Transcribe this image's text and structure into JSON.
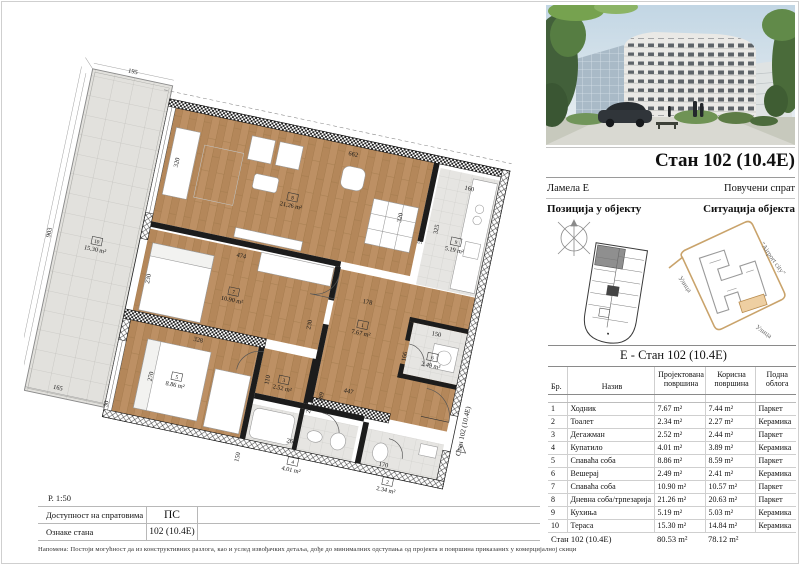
{
  "header": {
    "title": "Стан 102 (10.4Е)",
    "lamela": "Ламела Е",
    "floor": "Повучени спрат",
    "position_label": "Позиција у објекту",
    "situation_label": "Ситуација објекта"
  },
  "situation": {
    "label_top": "\"Airport city\"",
    "label_left": "Улица",
    "label_bottom": "Улица"
  },
  "area_table": {
    "title": "Е - Стан 102 (10.4Е)",
    "headers": {
      "no": "Бр.",
      "name": "Назив",
      "projected": "Пројектована површина",
      "useful": "Корисна површина",
      "flooring": "Подна облога"
    },
    "rows": [
      {
        "no": "1",
        "name": "Ходник",
        "projected": "7.67 m²",
        "useful": "7.44 m²",
        "flooring": "Паркет"
      },
      {
        "no": "2",
        "name": "Тоалет",
        "projected": "2.34 m²",
        "useful": "2.27 m²",
        "flooring": "Керамика"
      },
      {
        "no": "3",
        "name": "Дегажман",
        "projected": "2.52 m²",
        "useful": "2.44 m²",
        "flooring": "Паркет"
      },
      {
        "no": "4",
        "name": "Купатило",
        "projected": "4.01 m²",
        "useful": "3.89 m²",
        "flooring": "Керамика"
      },
      {
        "no": "5",
        "name": "Спаваћа соба",
        "projected": "8.86 m²",
        "useful": "8.59 m²",
        "flooring": "Паркет"
      },
      {
        "no": "6",
        "name": "Вешерај",
        "projected": "2.49 m²",
        "useful": "2.41 m²",
        "flooring": "Керамика"
      },
      {
        "no": "7",
        "name": "Спаваћа соба",
        "projected": "10.90 m²",
        "useful": "10.57 m²",
        "flooring": "Паркет"
      },
      {
        "no": "8",
        "name": "Дневна соба/трпезарија",
        "projected": "21.26 m²",
        "useful": "20.63 m²",
        "flooring": "Паркет"
      },
      {
        "no": "9",
        "name": "Кухиња",
        "projected": "5.19 m²",
        "useful": "5.03 m²",
        "flooring": "Керамика"
      },
      {
        "no": "10",
        "name": "Тераса",
        "projected": "15.30 m²",
        "useful": "14.84 m²",
        "flooring": "Керамика"
      }
    ],
    "total": {
      "label": "Стан 102 (10.4Е)",
      "projected": "80.53 m²",
      "useful": "78.12 m²",
      "flooring": ""
    }
  },
  "plan": {
    "scale": "Р. 1:50",
    "entrance_label": "Стан 102 (10.4Е)",
    "rooms": [
      {
        "num": "1",
        "area": "7.67 m²",
        "x": 352,
        "y": 228
      },
      {
        "num": "2",
        "area": "2.34 m²",
        "x": 412,
        "y": 384
      },
      {
        "num": "3",
        "area": "2.52 m²",
        "x": 283,
        "y": 302
      },
      {
        "num": "4",
        "area": "4.01 m²",
        "x": 310,
        "y": 384
      },
      {
        "num": "5",
        "area": "8.86 m²",
        "x": 172,
        "y": 322
      },
      {
        "num": "6",
        "area": "2.49 m²",
        "x": 431,
        "y": 246
      },
      {
        "num": "7",
        "area": "10.90 m²",
        "x": 212,
        "y": 222
      },
      {
        "num": "8",
        "area": "21.26 m²",
        "x": 252,
        "y": 112
      },
      {
        "num": "9",
        "area": "5.19 m²",
        "x": 430,
        "y": 122
      },
      {
        "num": "10",
        "area": "15.30 m²",
        "x": 60,
        "y": 200
      }
    ],
    "dim_labels": [
      {
        "text": "195",
        "x": 60,
        "y": 10,
        "rot": 0
      },
      {
        "text": "903",
        "x": 11,
        "y": 192,
        "rot": -90
      },
      {
        "text": "165",
        "x": 52,
        "y": 352,
        "rot": 0
      },
      {
        "text": "30",
        "x": 107,
        "y": 356,
        "rot": -90
      },
      {
        "text": "662",
        "x": 305,
        "y": 47,
        "rot": 0
      },
      {
        "text": "320",
        "x": 369,
        "y": 100,
        "rot": -90
      },
      {
        "text": "320",
        "x": 127,
        "y": 92,
        "rot": -90
      },
      {
        "text": "511",
        "x": 395,
        "y": 118,
        "rot": -90
      },
      {
        "text": "160",
        "x": 432,
        "y": 57,
        "rot": 0
      },
      {
        "text": "325",
        "x": 409,
        "y": 104,
        "rot": -90
      },
      {
        "text": "474",
        "x": 212,
        "y": 176,
        "rot": 0
      },
      {
        "text": "230",
        "x": 123,
        "y": 218,
        "rot": -90
      },
      {
        "text": "230",
        "x": 299,
        "y": 230,
        "rot": -90
      },
      {
        "text": "178",
        "x": 352,
        "y": 196,
        "rot": 0
      },
      {
        "text": "150",
        "x": 430,
        "y": 214,
        "rot": 0
      },
      {
        "text": "166",
        "x": 404,
        "y": 242,
        "rot": -90
      },
      {
        "text": "447",
        "x": 352,
        "y": 292,
        "rot": 0
      },
      {
        "text": "189",
        "x": 327,
        "y": 302,
        "rot": -90
      },
      {
        "text": "110",
        "x": 268,
        "y": 296,
        "rot": -90
      },
      {
        "text": "25",
        "x": 317,
        "y": 318,
        "rot": -90
      },
      {
        "text": "270",
        "x": 147,
        "y": 318,
        "rot": -90
      },
      {
        "text": "328",
        "x": 186,
        "y": 272,
        "rot": 0
      },
      {
        "text": "267",
        "x": 304,
        "y": 356,
        "rot": 0
      },
      {
        "text": "150",
        "x": 254,
        "y": 382,
        "rot": -90
      },
      {
        "text": "170",
        "x": 404,
        "y": 360,
        "rot": 0
      }
    ]
  },
  "footer": {
    "availability_label": "Доступност на спратовима",
    "availability_value": "ПС",
    "unit_label": "Ознаке стана",
    "unit_value": "102 (10.4Е)",
    "note": "Напомена: Постоји могућност да из конструктивних разлога, као и услед извођачких детаља, дође до минималних одступања од пројекта и површина приказаних у комерцијалној скици"
  },
  "colors": {
    "wood": "#bd9064",
    "tile": "#e6e5e2",
    "parcel_tan": "#c9a36b",
    "highlight_tan": "#eecfa2"
  }
}
